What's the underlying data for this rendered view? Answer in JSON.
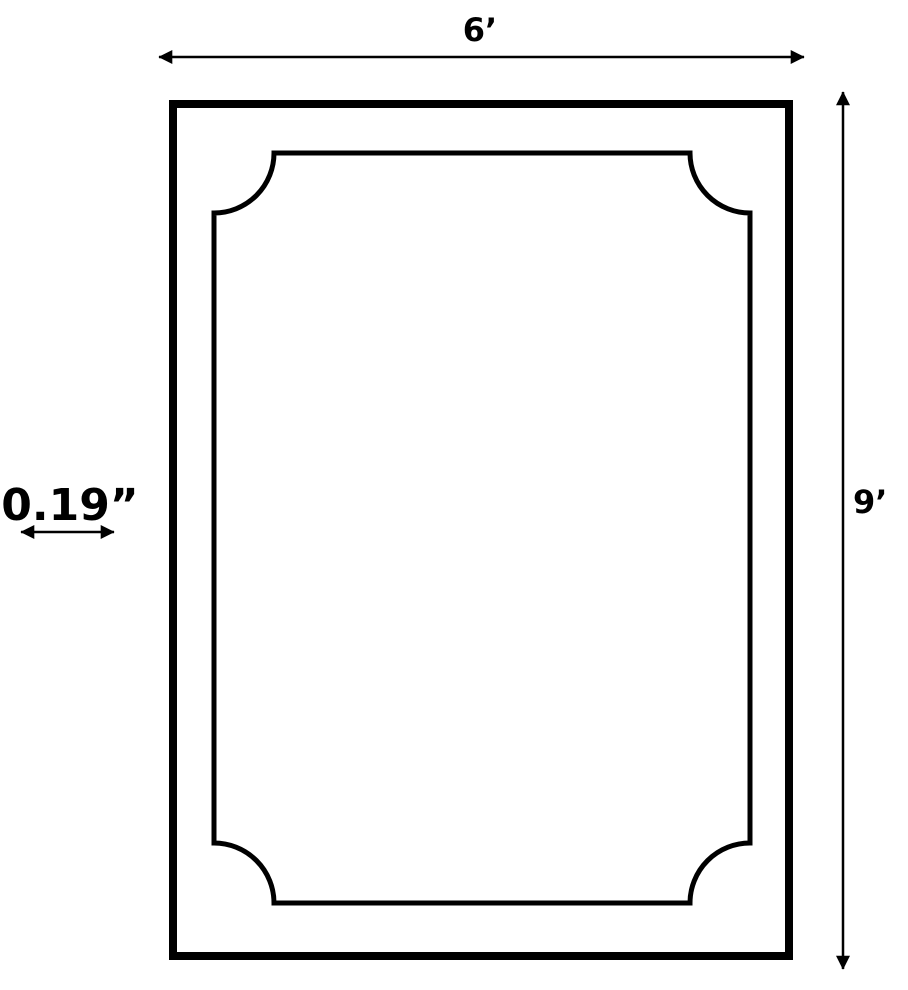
{
  "diagram": {
    "background_color": "#ffffff",
    "line_color": "#000000",
    "labels": {
      "width": "6’",
      "height": "9’",
      "border_thickness": "0.19”"
    },
    "shape": {
      "outer_frame": "rectangle",
      "inner_outline": "rectangle with concave scalloped corners"
    }
  }
}
